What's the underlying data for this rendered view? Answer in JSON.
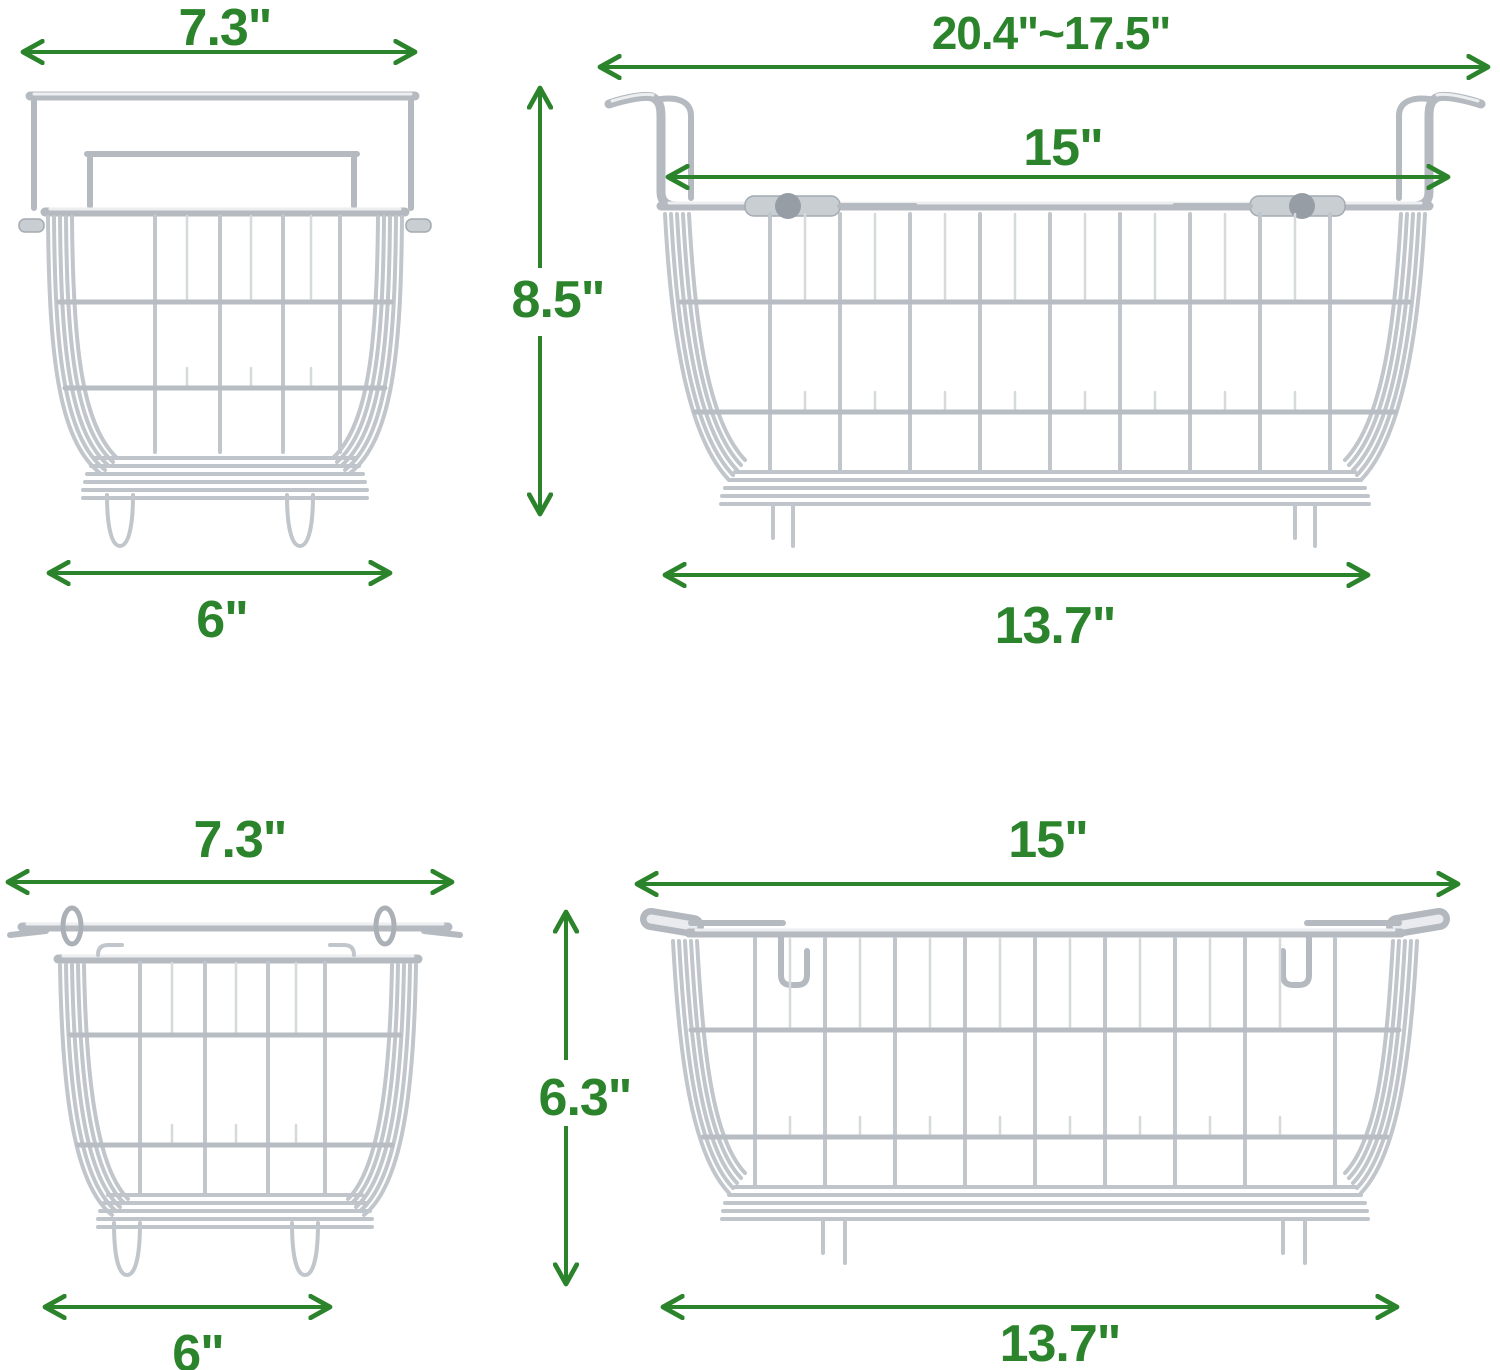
{
  "title": "Wire freezer basket dimensions diagram",
  "colors": {
    "dimension_green": "#2b842b",
    "wire": "#b4bac0",
    "wire_light": "#eceef0",
    "wire_dark": "#969da4",
    "background": "#ffffff"
  },
  "figures": {
    "top_left": {
      "name": "small hanging basket side view",
      "dims": {
        "top_width": "7.3\"",
        "bottom_width": "6\""
      }
    },
    "top_right": {
      "name": "large hanging basket front view with extendable hooks",
      "dims": {
        "hook_span": "20.4\"~17.5\"",
        "inner_width": "15\"",
        "height": "8.5\"",
        "bottom_width": "13.7\""
      }
    },
    "bottom_left": {
      "name": "small basket front view with folded handles",
      "dims": {
        "top_width": "7.3\"",
        "bottom_width": "6\""
      }
    },
    "bottom_right": {
      "name": "large basket front view with folded handles",
      "dims": {
        "top_width": "15\"",
        "height": "6.3\"",
        "bottom_width": "13.7\""
      }
    }
  }
}
